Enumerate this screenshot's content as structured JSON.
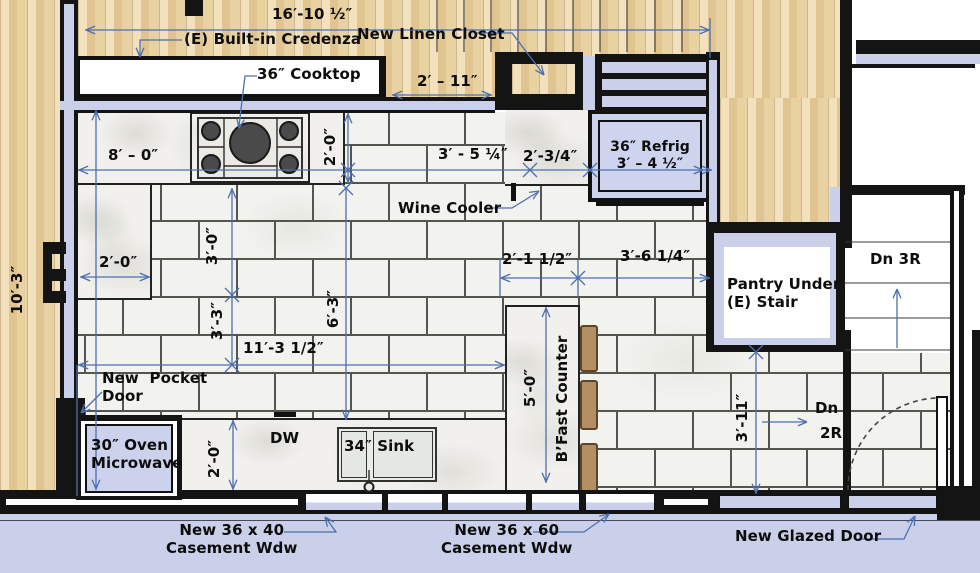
{
  "labels": {
    "credenza": "(E) Built-in Credenza",
    "linen_closet": "New Linen Closet",
    "cooktop": "36″ Cooktop",
    "refrig_1": "36″ Refrig",
    "refrig_2": "3′ – 4 ½″",
    "wine_cooler": "Wine Cooler",
    "pantry_1": "Pantry Under",
    "pantry_2": "(E) Stair",
    "dn_3r": "Dn 3R",
    "dn_2r_1": "Dn",
    "dn_2r_2": "2R",
    "pocket_door_1": "New  Pocket",
    "pocket_door_2": "Door",
    "oven_1": "30″ Oven",
    "oven_2": "Microwave",
    "dw": "DW",
    "sink": "34″ Sink",
    "bfast_counter": "B’Fast Counter",
    "window_40_1": "New 36 x 40",
    "window_40_2": "Casement Wdw",
    "window_60_1": "New 36 x 60",
    "window_60_2": "Casement Wdw",
    "glazed_door": "New Glazed Door"
  },
  "dimensions": {
    "overall_top": "16′-10 ½″",
    "left_wall": "10′-3″",
    "counter_run": "8′ – 0″",
    "counter_depth": "2′-0″",
    "linen_offset": "2′ – 11″",
    "cooktop_to_cooler": "3′ - 5 ¼″",
    "cooler_to_refrig": "2′-3/4″",
    "alcove": "2′-0″",
    "left_cab_a": "3′-0″",
    "left_cab_b": "3′-3″",
    "floor_mid": "6′-3″",
    "floor_main": "11′-3 1/2″",
    "counter_top_w": "2′-1 1/2″",
    "counter_to_pantry": "3′-6 1/4″",
    "bfast_len": "5′-0″",
    "base_depth": "2′-0″",
    "stair_drop": "3′-11″"
  },
  "colors": {
    "wall": "#141414",
    "lavender": "#cbd0ea",
    "wood": "#e9d2a2",
    "tile": "#f2f2ee",
    "dimension_line": "#4e6fae",
    "stool": "#b48f66"
  }
}
